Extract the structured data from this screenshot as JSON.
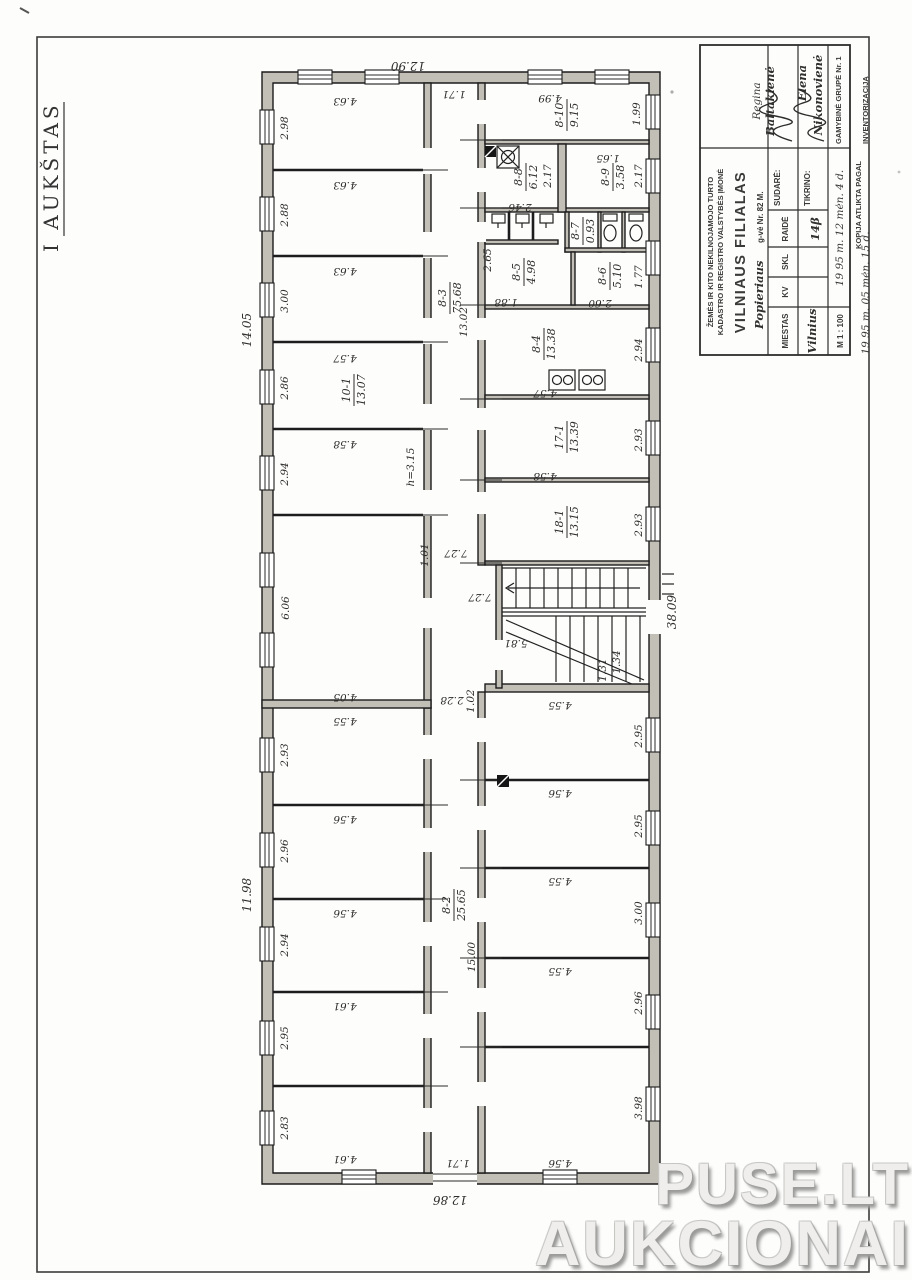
{
  "doc": {
    "floor_label": "I AUKŠTAS"
  },
  "watermark": {
    "line1": "PUSE.LT",
    "line2": "AUKCIONAI"
  },
  "title_block": {
    "org_line1": "ŽEMĖS IR KITO NEKILNOJAMOJO TURTO",
    "org_line2": "KADASTRO IR REGISTRO VALSTYBĖS ĮMONĖ",
    "branch": "VILNIAUS FILIALAS",
    "street_hand": "Popieriaus",
    "street_label": "g-vė Nr. 82 M.",
    "col_city": "MIESTAS",
    "city_value": "Vilnius",
    "col_kv": "KV",
    "col_skl": "SKL",
    "col_raide": "RAIDĖ",
    "raide_value": "14β",
    "sudare_label": "SUDARĖ:",
    "sudare_first": "Regina",
    "sudare_last": "Baltakienė",
    "tikrino_label": "TIKRINO:",
    "tikrino_first": "Elena",
    "tikrino_last": "Nikonovienė",
    "scale": "M 1 : 100",
    "date_made": "19 95 m. 12 mėn. 4 d.",
    "group": "GAMYBINĖ GRUPĖ Nr. 1",
    "copy_line": "KOPIJA ATLIKTA PAGAL",
    "copy_date": "19 95 m. 05 mėn. 15 d.",
    "copy_object": "INVENTORIZACIJĄ"
  },
  "plan": {
    "overall": {
      "top": "12.90",
      "bottom": "12.86",
      "left_upper": "14.05",
      "left_lower": "11.98",
      "right": "38.09"
    },
    "lt": {
      "w": [
        "4.63",
        "4.63",
        "4.63",
        "4.57",
        "4.58"
      ],
      "h": [
        "2.98",
        "2.88",
        "3.00",
        "2.86",
        "2.94"
      ]
    },
    "lb": {
      "w": [
        "4.55",
        "4.56",
        "4.56",
        "4.61",
        "4.61"
      ],
      "h": [
        "2.93",
        "2.96",
        "2.94",
        "2.95",
        "2.83"
      ]
    },
    "rb": {
      "w": [
        "4.55",
        "4.56",
        "4.55",
        "4.55",
        "4.56"
      ],
      "h": [
        "2.95",
        "2.95",
        "3.00",
        "2.96",
        "3.98"
      ]
    },
    "rooms": {
      "c_top": {
        "no": "8-3",
        "area": "75.68",
        "len": "13.02",
        "wid": "1.71"
      },
      "c_bot": {
        "no": "8-2",
        "area": "25.65",
        "len": "15.00",
        "wid": "1.71"
      },
      "r10": {
        "no": "8-10",
        "area": "9.15",
        "w": "4.99",
        "h": "1.99"
      },
      "r8": {
        "no": "8-8",
        "area": "6.12",
        "w": "2.46",
        "h": "2.17"
      },
      "r9": {
        "no": "8-9",
        "area": "3.58",
        "w": "1.65",
        "h": "2.17"
      },
      "r7": {
        "no": "8-7",
        "area": "0.93"
      },
      "r5": {
        "no": "8-5",
        "area": "4.98",
        "w": "2.65",
        "h": "1.88"
      },
      "r6": {
        "no": "8-6",
        "area": "5.10",
        "w": "2.60",
        "h": "1.77"
      },
      "r4": {
        "no": "8-4",
        "area": "13.38",
        "h": "2.94"
      },
      "r17": {
        "no": "17-1",
        "area": "13.39",
        "w": "4.57",
        "h": "2.93"
      },
      "r18": {
        "no": "18-1",
        "area": "13.15",
        "w": "4.58",
        "h": "2.93"
      },
      "k10": {
        "no": "10-1",
        "area": "13.07"
      },
      "big": {
        "h": "6.06",
        "w": "4.05"
      }
    },
    "misc": {
      "h_note": "h=3.15",
      "hall1": "7.27",
      "hall2": "7.27",
      "stair_hall": "5.81",
      "d228": "2.28",
      "d102": "1.02",
      "d101": "1.01",
      "d134": "1.34",
      "d131": "1.31"
    }
  }
}
